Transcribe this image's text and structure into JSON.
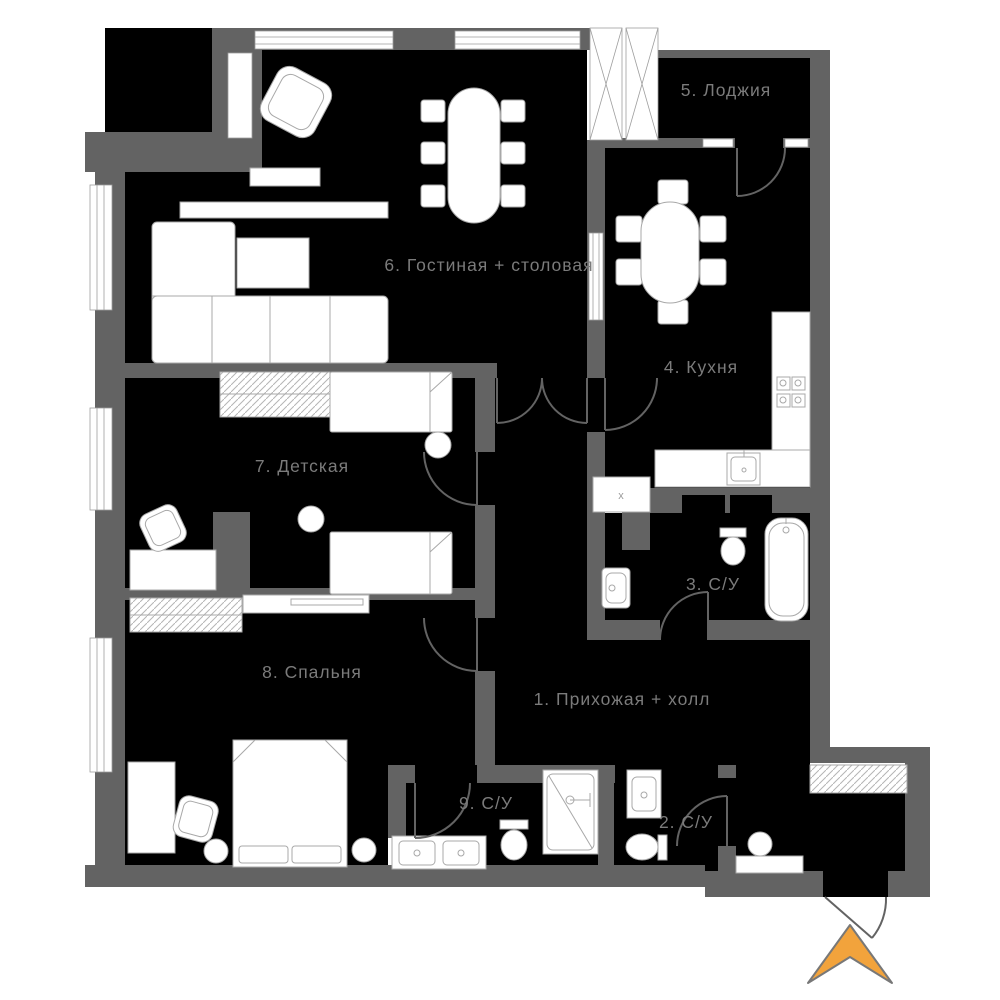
{
  "plan": {
    "title": "apartment-floor-plan",
    "language": "ru",
    "rooms": {
      "hall": {
        "label": "1. Прихожая + холл"
      },
      "bath2": {
        "label": "2. С/У"
      },
      "bath3": {
        "label": "3. С/У"
      },
      "kitchen": {
        "label": "4. Кухня"
      },
      "loggia": {
        "label": "5. Лоджия"
      },
      "living": {
        "label": "6. Гостиная + столовая"
      },
      "kids": {
        "label": "7. Детская"
      },
      "bedroom": {
        "label": "8. Спальня"
      },
      "bath9": {
        "label": "9. С/У"
      }
    },
    "fixtures": {
      "washer_mark": "x"
    },
    "colors": {
      "background": "#ffffff",
      "room_fill": "#000000",
      "wall": "#636363",
      "furniture_outline": "#a8a8a8",
      "label_text": "#7b7b7b",
      "entrance_arrow": "#F2A33C"
    }
  }
}
